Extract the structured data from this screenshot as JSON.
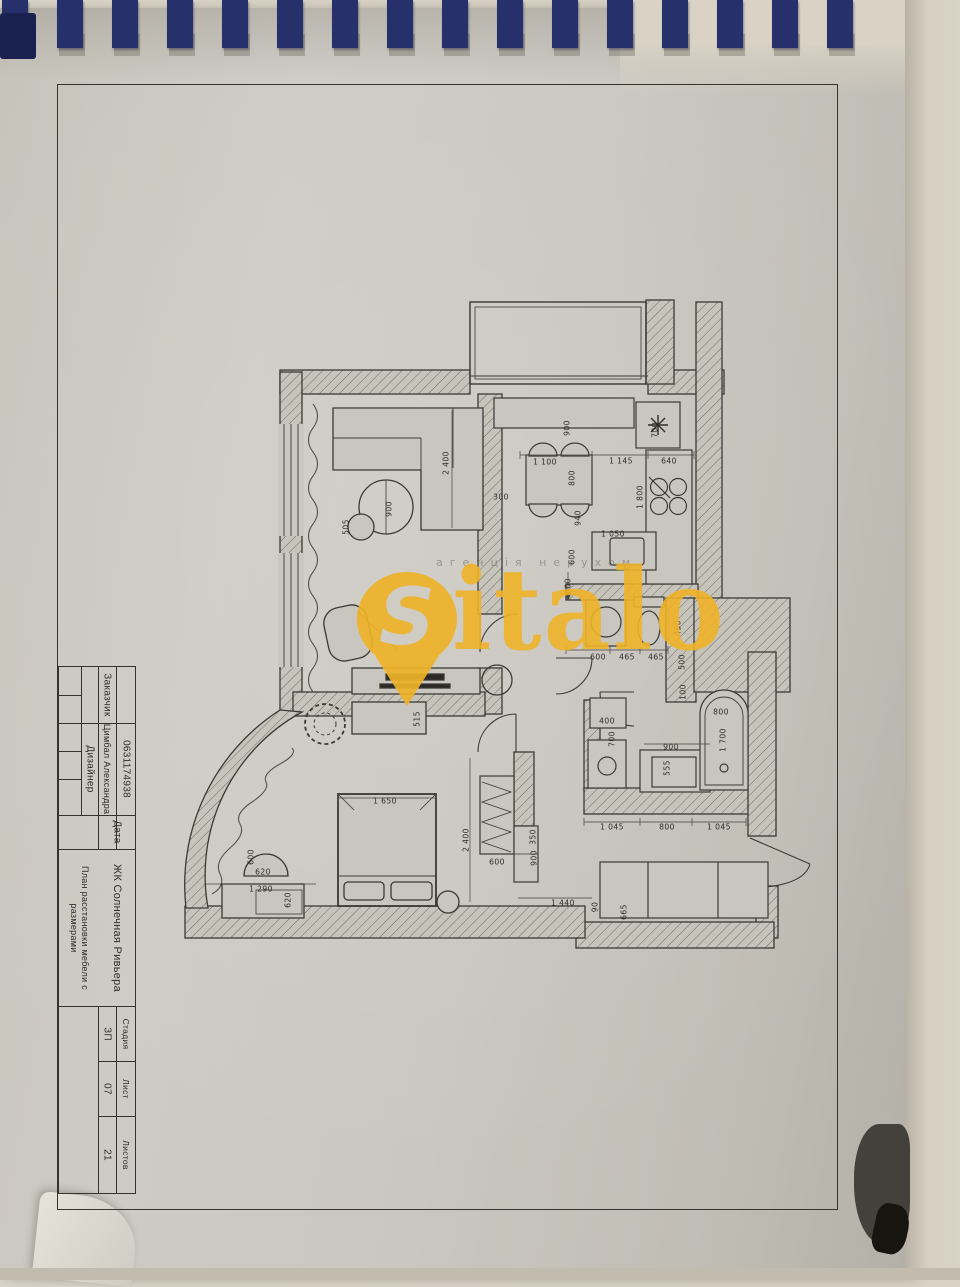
{
  "title_block": {
    "customer_label": "Заказчик",
    "designer_label": "Дизайнер",
    "designer_name": "Цимбал Александра",
    "phone": "0631174938",
    "date_label": "Дата",
    "project": "ЖК Солнечная Ривьера",
    "sheet_title": "План расстановки мебели с размерами",
    "stage_label": "Стадия",
    "stage_value": "ЗП",
    "sheet_label": "Лист",
    "sheet_value": "07",
    "sheets_label": "Листов",
    "sheets_value": "21"
  },
  "watermark": {
    "brand_initial": "S",
    "brand_rest": "italo",
    "tagline": "агенція нерухом",
    "brand_color": "#eeb228"
  },
  "plan": {
    "dimensions": [
      {
        "t": "900",
        "x": 567,
        "y": 428,
        "r": -90
      },
      {
        "t": "1 100",
        "x": 545,
        "y": 462,
        "r": 0
      },
      {
        "t": "1 145",
        "x": 621,
        "y": 461,
        "r": 0
      },
      {
        "t": "640",
        "x": 669,
        "y": 461,
        "r": 0
      },
      {
        "t": "700",
        "x": 655,
        "y": 430,
        "r": -90
      },
      {
        "t": "800",
        "x": 572,
        "y": 478,
        "r": -90
      },
      {
        "t": "940",
        "x": 578,
        "y": 518,
        "r": -90
      },
      {
        "t": "600",
        "x": 572,
        "y": 557,
        "r": -90
      },
      {
        "t": "1 800",
        "x": 640,
        "y": 497,
        "r": -90
      },
      {
        "t": "1 050",
        "x": 613,
        "y": 534,
        "r": 0
      },
      {
        "t": "600",
        "x": 568,
        "y": 586,
        "r": -90
      },
      {
        "t": "300",
        "x": 501,
        "y": 497,
        "r": 0
      },
      {
        "t": "2 400",
        "x": 446,
        "y": 463,
        "r": -90
      },
      {
        "t": "900",
        "x": 389,
        "y": 509,
        "r": -90
      },
      {
        "t": "505",
        "x": 346,
        "y": 527,
        "r": -90
      },
      {
        "t": "600",
        "x": 598,
        "y": 657,
        "r": 0
      },
      {
        "t": "465",
        "x": 627,
        "y": 657,
        "r": 0
      },
      {
        "t": "465",
        "x": 656,
        "y": 657,
        "r": 0
      },
      {
        "t": "450",
        "x": 678,
        "y": 628,
        "r": -90
      },
      {
        "t": "500",
        "x": 682,
        "y": 662,
        "r": -90
      },
      {
        "t": "100",
        "x": 683,
        "y": 692,
        "r": -90
      },
      {
        "t": "400",
        "x": 607,
        "y": 721,
        "r": 0
      },
      {
        "t": "700",
        "x": 612,
        "y": 739,
        "r": -90
      },
      {
        "t": "900",
        "x": 671,
        "y": 747,
        "r": 0
      },
      {
        "t": "555",
        "x": 667,
        "y": 768,
        "r": -90
      },
      {
        "t": "800",
        "x": 721,
        "y": 712,
        "r": 0
      },
      {
        "t": "1 700",
        "x": 723,
        "y": 740,
        "r": -90
      },
      {
        "t": "1 045",
        "x": 612,
        "y": 827,
        "r": 0
      },
      {
        "t": "800",
        "x": 667,
        "y": 827,
        "r": 0
      },
      {
        "t": "1 045",
        "x": 719,
        "y": 827,
        "r": 0
      },
      {
        "t": "1 440",
        "x": 563,
        "y": 903,
        "r": 0
      },
      {
        "t": "90",
        "x": 595,
        "y": 907,
        "r": -90
      },
      {
        "t": "665",
        "x": 624,
        "y": 912,
        "r": -90
      },
      {
        "t": "1 650",
        "x": 385,
        "y": 801,
        "r": 0
      },
      {
        "t": "2 400",
        "x": 466,
        "y": 840,
        "r": -90
      },
      {
        "t": "600",
        "x": 497,
        "y": 862,
        "r": 0
      },
      {
        "t": "350",
        "x": 533,
        "y": 837,
        "r": -90
      },
      {
        "t": "900",
        "x": 534,
        "y": 858,
        "r": -90
      },
      {
        "t": "600",
        "x": 251,
        "y": 857,
        "r": -90
      },
      {
        "t": "620",
        "x": 263,
        "y": 872,
        "r": 0
      },
      {
        "t": "1 290",
        "x": 261,
        "y": 889,
        "r": 0
      },
      {
        "t": "620",
        "x": 288,
        "y": 900,
        "r": -90
      },
      {
        "t": "515",
        "x": 417,
        "y": 719,
        "r": -90
      }
    ]
  }
}
